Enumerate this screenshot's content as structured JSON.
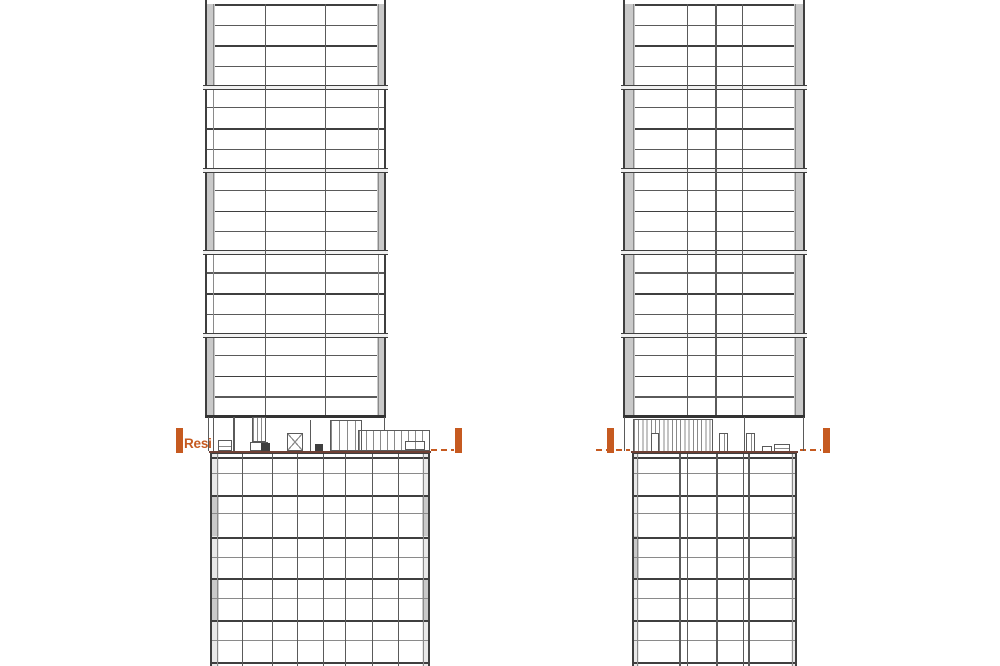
{
  "labels": {
    "resi": "Resi"
  },
  "colors": {
    "accent": "#C65A20",
    "roof": "#6E4034",
    "line_dark": "#3F3F3F",
    "line_med": "#5A5A5A",
    "line_mid": "#8A8A8A",
    "line_light": "#A8A8A8",
    "panel_grey": "#C9C9C9",
    "panel_light": "#E9E9E9",
    "joint_fill": "#F1F1F1",
    "dark_fill": "#3F3F3F",
    "bg": "#FFFFFF"
  },
  "drawing": {
    "canvas": {
      "w": 1000,
      "h": 666
    },
    "shaft_top_y": 4,
    "floor_spacing": 20.65,
    "floor_count": 20,
    "shaft_bottom_y": 415,
    "datum_y": 449,
    "roof_y": 450.6,
    "towers": [
      {
        "name": "west",
        "shaft": {
          "x": 205,
          "w": 181,
          "edge_w": 8,
          "grey_modules": [
            0,
            2,
            4
          ],
          "mullions": [
            {
              "x": 60,
              "wt": 1.3
            },
            {
              "x": 120,
              "wt": 1.3
            }
          ]
        },
        "plant_items": [
          {
            "t": "vline",
            "x": 208,
            "y": 417,
            "h": 34
          },
          {
            "t": "vline",
            "x": 213,
            "y": 417,
            "h": 34
          },
          {
            "t": "box",
            "x": 218,
            "y": 440,
            "w": 14,
            "h": 11,
            "inner": "h"
          },
          {
            "t": "vline",
            "x": 233,
            "y": 417,
            "h": 34,
            "wt": 1.5
          },
          {
            "t": "hatch",
            "x": 252,
            "y": 417,
            "w": 14,
            "h": 25,
            "sp": 4,
            "outline": true
          },
          {
            "t": "box",
            "x": 250,
            "y": 442,
            "w": 18,
            "h": 9
          },
          {
            "t": "dark",
            "x": 261,
            "y": 443,
            "w": 9,
            "h": 9
          },
          {
            "t": "xbrace",
            "x": 287,
            "y": 433,
            "w": 16,
            "h": 18
          },
          {
            "t": "vline",
            "x": 310,
            "y": 420,
            "h": 31
          },
          {
            "t": "dark",
            "x": 315,
            "y": 444,
            "w": 8,
            "h": 8
          },
          {
            "t": "hatch",
            "x": 330,
            "y": 420,
            "w": 32,
            "h": 31,
            "sp": 8,
            "outline": true
          },
          {
            "t": "hatch",
            "x": 358,
            "y": 430,
            "w": 72,
            "h": 21,
            "sp": 7,
            "outline": true
          },
          {
            "t": "box",
            "x": 405,
            "y": 441,
            "w": 20,
            "h": 9,
            "inner": "v"
          },
          {
            "t": "vline",
            "x": 384,
            "y": 417,
            "h": 13
          }
        ],
        "podium": {
          "x": 210,
          "y": 452,
          "w": 220,
          "h": 214,
          "edge_w": 7,
          "mullions": [
            {
              "x": 32
            },
            {
              "x": 62
            },
            {
              "x": 87
            },
            {
              "x": 113
            },
            {
              "x": 135
            },
            {
              "x": 162
            },
            {
              "x": 188
            }
          ],
          "majors": [
            4.5,
            43,
            84.5,
            126,
            168,
            209.5
          ],
          "minors": [
            21,
            61,
            105,
            146,
            188
          ],
          "grey_blocks": [
            {
              "side": "left",
              "y": 43,
              "h": 41
            },
            {
              "side": "right",
              "y": 43,
              "h": 41
            },
            {
              "side": "left",
              "y": 126,
              "h": 42
            },
            {
              "side": "right",
              "y": 126,
              "h": 42
            }
          ]
        },
        "roof": {
          "x": 210,
          "w": 220
        },
        "datum": {
          "bars": [
            {
              "x": 176,
              "y": 428
            },
            {
              "x": 455,
              "y": 428
            }
          ],
          "dashes": [
            [
              431,
              454
            ]
          ],
          "has_label": true
        }
      },
      {
        "name": "east",
        "shaft": {
          "x": 623,
          "w": 182,
          "edge_w": 10,
          "grey_modules": [
            0,
            1,
            2,
            3,
            4
          ],
          "mullions": [
            {
              "x": 64,
              "wt": 1
            },
            {
              "x": 92,
              "wt": 1.5
            },
            {
              "x": 119,
              "wt": 1
            }
          ]
        },
        "plant_items": [
          {
            "t": "vline",
            "x": 624,
            "y": 417,
            "h": 34
          },
          {
            "t": "vline",
            "x": 803,
            "y": 417,
            "h": 34
          },
          {
            "t": "hatch",
            "x": 633,
            "y": 419,
            "w": 80,
            "h": 33,
            "sp": 4.2,
            "outline": true
          },
          {
            "t": "door",
            "x": 651,
            "y": 433,
            "w": 8,
            "h": 19
          },
          {
            "t": "door",
            "x": 719,
            "y": 433,
            "w": 9,
            "h": 19,
            "inner": "v"
          },
          {
            "t": "vline",
            "x": 744,
            "y": 417,
            "h": 34,
            "wt": 1.4
          },
          {
            "t": "door",
            "x": 746,
            "y": 433,
            "w": 9,
            "h": 19,
            "inner": "v"
          },
          {
            "t": "box",
            "x": 762,
            "y": 446,
            "w": 10,
            "h": 6
          },
          {
            "t": "box",
            "x": 774,
            "y": 444,
            "w": 16,
            "h": 8,
            "inner": "h"
          }
        ],
        "podium": {
          "x": 632,
          "y": 452,
          "w": 165,
          "h": 214,
          "edge_w": 5,
          "mullions": [
            {
              "x": 47,
              "wt": 1.5
            },
            {
              "x": 55
            },
            {
              "x": 84,
              "wt": 1.5
            },
            {
              "x": 111
            },
            {
              "x": 116,
              "wt": 1.5
            }
          ],
          "majors": [
            4.5,
            43,
            84.5,
            126,
            168,
            209.5
          ],
          "minors": [
            21,
            61,
            105,
            146,
            188
          ],
          "grey_blocks": [
            {
              "side": "left",
              "y": 84,
              "h": 42
            },
            {
              "side": "right",
              "y": 84,
              "h": 42
            }
          ]
        },
        "roof": {
          "x": 632,
          "w": 165
        },
        "datum": {
          "bars": [
            {
              "x": 607,
              "y": 428
            },
            {
              "x": 823,
              "y": 428
            }
          ],
          "dashes": [
            [
              596,
              630
            ],
            [
              800,
              821
            ]
          ],
          "has_label": false
        }
      }
    ]
  }
}
